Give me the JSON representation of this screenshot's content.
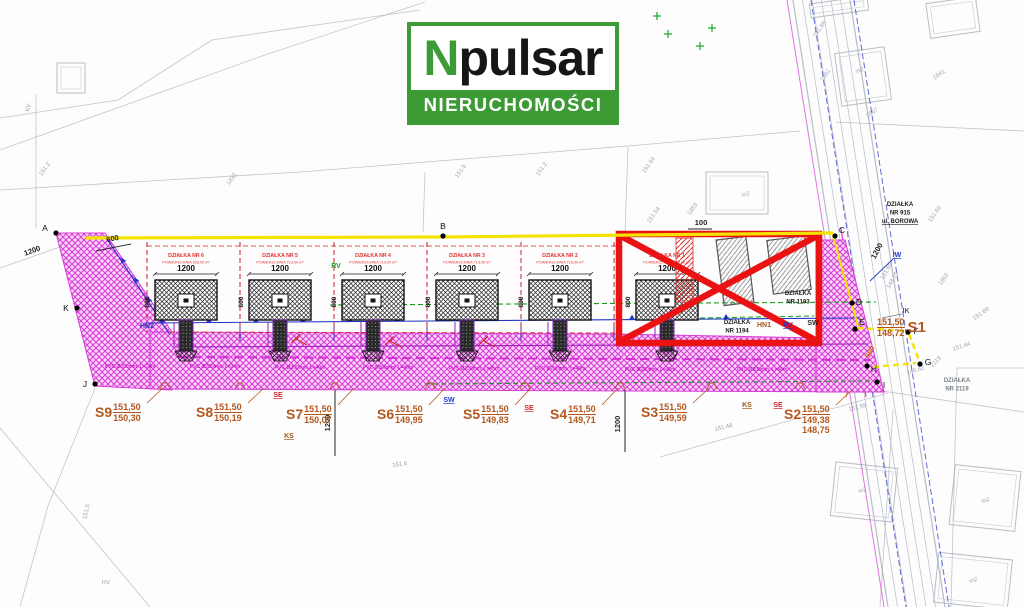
{
  "logo": {
    "n": "N",
    "rest": "pulsar",
    "subtitle": "NIERUCHOMOŚCI"
  },
  "colors": {
    "accent_green": "#3d9b35",
    "plot_red": "#e03030",
    "road_magenta": "#d83bd8",
    "marker_red": "#ea1212",
    "survey_orange": "#b4571d",
    "line_yellow": "#f3e300",
    "line_blue": "#2436c8",
    "line_green": "#1a9a1a",
    "line_purple": "#a020c0",
    "bg_gray": "#8d939c"
  },
  "plan": {
    "plots": [
      {
        "name": "DZIAŁKA NR 6",
        "area": "POWIERZCHNIA 935,00 m²",
        "dim_w": "1200",
        "dim_h": "800",
        "cx": 186
      },
      {
        "name": "DZIAŁKA NR 5",
        "area": "POWIERZCHNIA 713,00 m²",
        "dim_w": "1200",
        "dim_h": "800",
        "cx": 280
      },
      {
        "name": "DZIAŁKA NR 4",
        "area": "POWIERZCHNIA 713,00 m²",
        "dim_w": "1200",
        "dim_h": "800",
        "cx": 373
      },
      {
        "name": "DZIAŁKA NR 3",
        "area": "POWIERZCHNIA 713,00 m²",
        "dim_w": "1200",
        "dim_h": "800",
        "cx": 467
      },
      {
        "name": "DZIAŁKA NR 2",
        "area": "POWIERZCHNIA 716,00 m²",
        "dim_w": "1200",
        "dim_h": "800",
        "cx": 560
      },
      {
        "name": "DZIAŁKA NR 1",
        "area": "POWIERZCHNIA 716,00 m²",
        "dim_w": "1200",
        "dim_h": "800",
        "cx": 667
      }
    ],
    "s_points": [
      {
        "name": "S9",
        "values": [
          "151,50",
          "150,30"
        ],
        "x": 95,
        "y": 402,
        "reversed": false
      },
      {
        "name": "S8",
        "values": [
          "151,50",
          "150,19"
        ],
        "x": 196,
        "y": 402,
        "reversed": false
      },
      {
        "name": "S7",
        "values": [
          "151,50",
          "150,07"
        ],
        "x": 286,
        "y": 404,
        "reversed": false
      },
      {
        "name": "S6",
        "values": [
          "151,50",
          "149,95"
        ],
        "x": 377,
        "y": 404,
        "reversed": false
      },
      {
        "name": "S5",
        "values": [
          "151,50",
          "149,83"
        ],
        "x": 463,
        "y": 404,
        "reversed": false
      },
      {
        "name": "S4",
        "values": [
          "151,50",
          "149,71"
        ],
        "x": 550,
        "y": 404,
        "reversed": false
      },
      {
        "name": "S3",
        "values": [
          "151,50",
          "149,59"
        ],
        "x": 641,
        "y": 402,
        "reversed": false
      },
      {
        "name": "S2",
        "values": [
          "151,50",
          "149,38",
          "148,75"
        ],
        "x": 784,
        "y": 404,
        "reversed": false
      },
      {
        "name": "S1",
        "values": [
          "151,50",
          "148,72"
        ],
        "x": 876,
        "y": 317,
        "reversed": true
      }
    ],
    "utility_tags": [
      {
        "text": "HN2",
        "color": "#2436c8",
        "x": 147,
        "y": 328,
        "u": false
      },
      {
        "text": "RV",
        "color": "#1a9a1a",
        "x": 336,
        "y": 268,
        "u": false
      },
      {
        "text": "SE",
        "color": "#cc2222",
        "x": 278,
        "y": 397,
        "u": true
      },
      {
        "text": "KS",
        "color": "#a05a1a",
        "x": 289,
        "y": 438,
        "u": true
      },
      {
        "text": "SW",
        "color": "#2436c8",
        "x": 449,
        "y": 402,
        "u": true
      },
      {
        "text": "SE",
        "color": "#cc2222",
        "x": 529,
        "y": 410,
        "u": true
      },
      {
        "text": "KS",
        "color": "#a05a1a",
        "x": 747,
        "y": 407,
        "u": true
      },
      {
        "text": "SE",
        "color": "#cc2222",
        "x": 778,
        "y": 407,
        "u": true
      },
      {
        "text": "HN1",
        "color": "#a05a1a",
        "x": 764,
        "y": 327,
        "u": false
      },
      {
        "text": "RV",
        "color": "#2436c8",
        "x": 788,
        "y": 327,
        "u": true
      },
      {
        "text": "SW",
        "color": "#222222",
        "x": 813,
        "y": 325,
        "u": false
      },
      {
        "text": "IW",
        "color": "#2436c8",
        "x": 897,
        "y": 257,
        "u": true
      },
      {
        "text": "IK",
        "color": "#555555",
        "x": 906,
        "y": 313,
        "u": false
      }
    ],
    "dims": [
      {
        "text": "600",
        "x": 113,
        "y": 241,
        "rot": -12,
        "color": "#222222"
      },
      {
        "text": "1200",
        "x": 33,
        "y": 253,
        "rot": -20,
        "color": "#222222"
      },
      {
        "text": "100",
        "x": 701,
        "y": 225,
        "rot": 0,
        "color": "#222222"
      },
      {
        "text": "1200",
        "x": 330,
        "y": 423,
        "rot": -90,
        "color": "#222222"
      },
      {
        "text": "1200",
        "x": 620,
        "y": 424,
        "rot": -90,
        "color": "#222222"
      },
      {
        "text": "1200",
        "x": 879,
        "y": 252,
        "rot": -62,
        "color": "#222222"
      },
      {
        "text": "590",
        "x": 872,
        "y": 353,
        "rot": -62,
        "color": "#cc7700"
      }
    ],
    "points": [
      {
        "name": "A",
        "x": 56,
        "y": 233,
        "dx": -11,
        "dy": -2
      },
      {
        "name": "K",
        "x": 77,
        "y": 308,
        "dx": -11,
        "dy": 3
      },
      {
        "name": "J",
        "x": 95,
        "y": 384,
        "dx": -10,
        "dy": 3
      },
      {
        "name": "B",
        "x": 443,
        "y": 236,
        "dx": 0,
        "dy": -7
      },
      {
        "name": "C",
        "x": 835,
        "y": 236,
        "dx": 7,
        "dy": -3
      },
      {
        "name": "D",
        "x": 852,
        "y": 303,
        "dx": 7,
        "dy": 2
      },
      {
        "name": "E",
        "x": 855,
        "y": 329,
        "dx": 7,
        "dy": -4
      },
      {
        "name": "F",
        "x": 908,
        "y": 332,
        "dx": 8,
        "dy": 2
      },
      {
        "name": "G",
        "x": 920,
        "y": 364,
        "dx": 8,
        "dy": 1
      },
      {
        "name": "H",
        "x": 867,
        "y": 366,
        "dx": 7,
        "dy": 6
      },
      {
        "name": "I",
        "x": 877,
        "y": 382,
        "dx": 7,
        "dy": 6
      }
    ],
    "area_labels": [
      {
        "lines": [
          "DZIAŁKA",
          "NR 915",
          "ul. BOROWA"
        ],
        "x": 900,
        "y": 206,
        "color": "#1a1a1a",
        "underline_line": 2
      },
      {
        "lines": [
          "DZIAŁKA",
          "NR 1193"
        ],
        "x": 798,
        "y": 295,
        "color": "#222222",
        "underline_line": -1
      },
      {
        "lines": [
          "DZIAŁKA",
          "NR 1194"
        ],
        "x": 737,
        "y": 324,
        "color": "#222222",
        "underline_line": -1
      },
      {
        "lines": [
          "DZIAŁKA",
          "NR 2119"
        ],
        "x": 957,
        "y": 382,
        "color": "#7a8088",
        "underline_line": -1
      }
    ],
    "pipe_labels": [
      {
        "text": "PVC Ø200mm, L=24m",
        "x": 130,
        "y": 368
      },
      {
        "text": "PVC Ø200mm, L=34m",
        "x": 215,
        "y": 368
      },
      {
        "text": "PVC Ø200mm, L=40m",
        "x": 300,
        "y": 369
      },
      {
        "text": "PVC Ø200mm, L=46m",
        "x": 388,
        "y": 369
      },
      {
        "text": "PVC Ø200mm, L=45m",
        "x": 474,
        "y": 370
      },
      {
        "text": "PVC Ø200mm, L=49m",
        "x": 560,
        "y": 370
      },
      {
        "text": "PVC Ø200mm, L=42m",
        "x": 650,
        "y": 371
      },
      {
        "text": "PVC Ø200mm, L=48m",
        "x": 762,
        "y": 371
      }
    ]
  },
  "background": {
    "labels": [
      [
        "151.2",
        46,
        170,
        -55
      ],
      [
        "1832",
        233,
        180,
        -55
      ],
      [
        "151.5",
        462,
        172,
        -55
      ],
      [
        "151.2",
        543,
        170,
        -55
      ],
      [
        "151.64",
        650,
        166,
        -55
      ],
      [
        "151.54",
        655,
        216,
        -55
      ],
      [
        "1853",
        694,
        210,
        -55
      ],
      [
        "m2",
        746,
        196,
        -15
      ],
      [
        "1361",
        827,
        76,
        -55
      ],
      [
        "151.86",
        821,
        30,
        -55
      ],
      [
        "1841",
        940,
        76,
        -35
      ],
      [
        "1867",
        873,
        114,
        -35
      ],
      [
        "m2",
        860,
        72,
        -15
      ],
      [
        "1802",
        945,
        280,
        -55
      ],
      [
        "151.66",
        936,
        215,
        -55
      ],
      [
        "151.65",
        888,
        272,
        -60
      ],
      [
        "148.79",
        894,
        281,
        -60
      ],
      [
        "151.88",
        982,
        315,
        -35
      ],
      [
        "151.58",
        858,
        409,
        -14
      ],
      [
        "151.48",
        724,
        429,
        -14
      ],
      [
        "151.44",
        962,
        348,
        -18
      ],
      [
        "2119",
        937,
        363,
        -45
      ],
      [
        "148.62",
        916,
        372,
        -18
      ],
      [
        "151.6",
        400,
        466,
        -8
      ],
      [
        "151.5",
        88,
        512,
        -78
      ],
      [
        "RV",
        106,
        584,
        0
      ],
      [
        "KV",
        30,
        108,
        -78
      ],
      [
        "m2",
        863,
        492,
        -18
      ],
      [
        "m2",
        986,
        502,
        -18
      ],
      [
        "m2",
        974,
        582,
        -18
      ]
    ],
    "green_marks": [
      [
        657,
        16
      ],
      [
        700,
        46
      ],
      [
        712,
        28
      ],
      [
        668,
        34
      ]
    ]
  }
}
